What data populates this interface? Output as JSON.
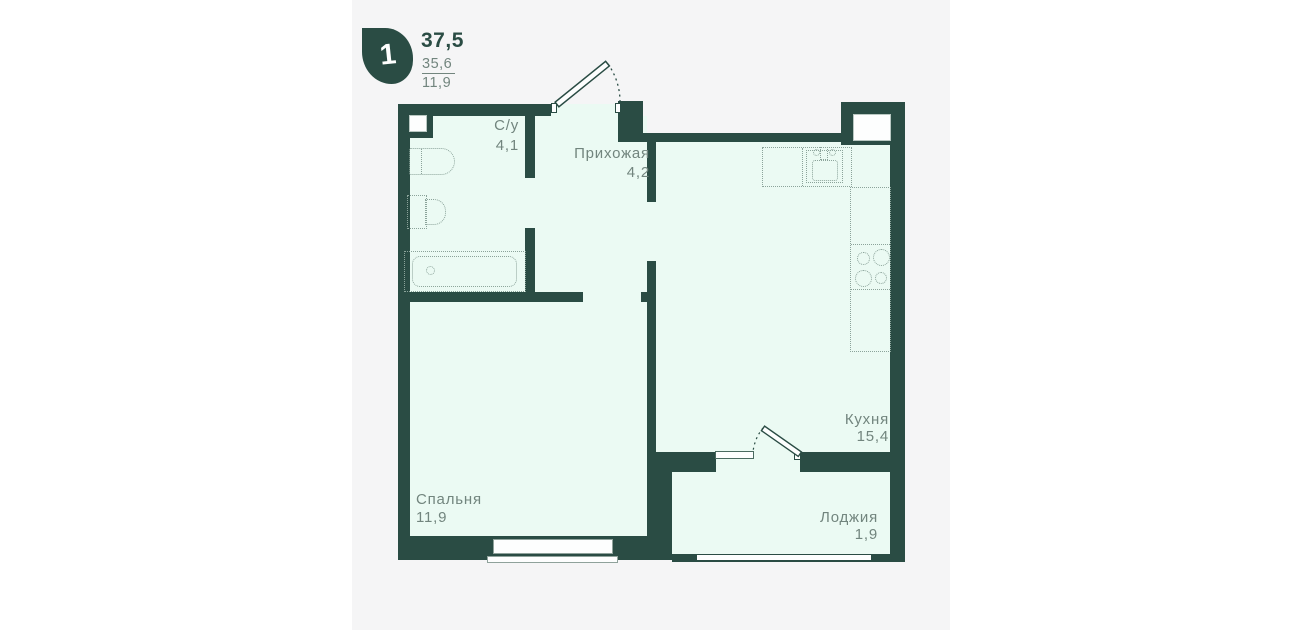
{
  "legend": {
    "rooms_count": "1",
    "area_total": "37,5",
    "area_living": "35,6",
    "area_room": "11,9"
  },
  "rooms": {
    "bathroom": {
      "label": "С/у",
      "area": "4,1"
    },
    "hallway": {
      "label": "Прихожая",
      "area": "4,2"
    },
    "kitchen": {
      "label": "Кухня",
      "area": "15,4"
    },
    "bedroom": {
      "label": "Спальня",
      "area": "11,9"
    },
    "loggia": {
      "label": "Лоджия",
      "area": "1,9"
    }
  },
  "colors": {
    "wall": "#2a4c44",
    "floor": "#ebfaf3",
    "label": "#72857e",
    "canvas": "#f5f5f6",
    "page": "#ffffff",
    "fixture": "#8ba39a",
    "glass": "#fdfefe"
  }
}
